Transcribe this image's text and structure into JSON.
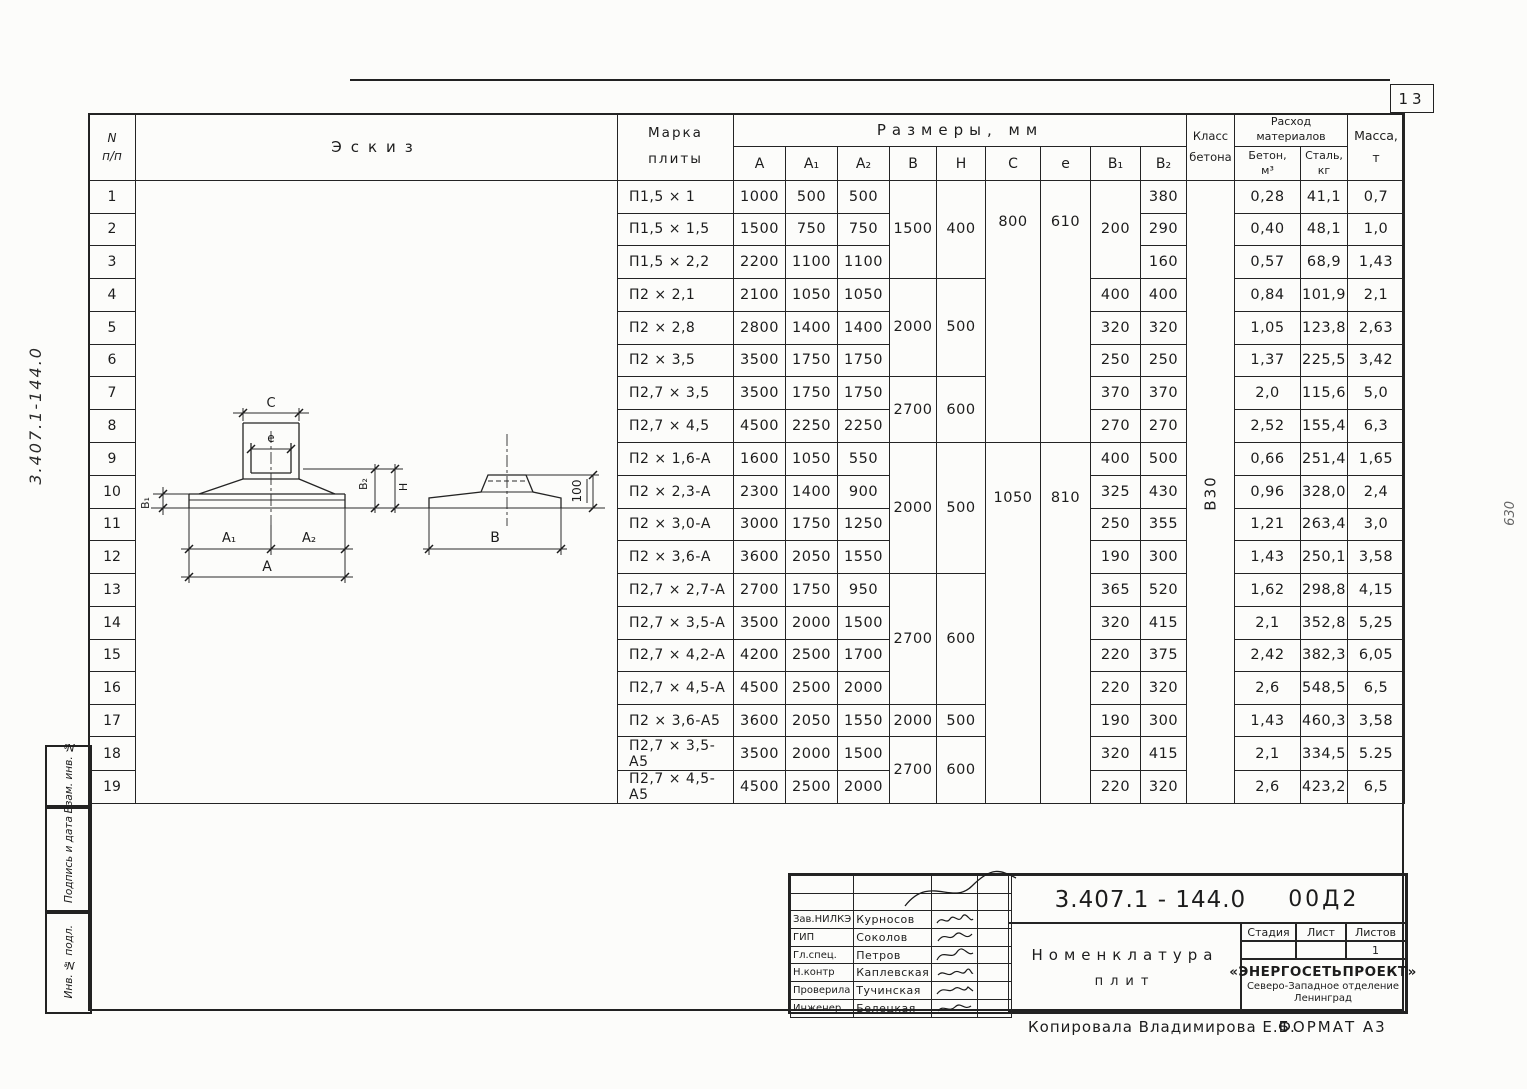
{
  "page": {
    "number": "13",
    "margin_doc_number": "3.407.1-144.0",
    "margin_note_right": "630",
    "copy_note": "Копировала  Владимирова Е.Б.",
    "format_note": "ФОРМАТ А3"
  },
  "left_strip": {
    "sections": [
      "Взам. инв. №",
      "Подпись и дата",
      "Инв. № подл."
    ]
  },
  "table": {
    "headers": {
      "num_top": "N",
      "num_bottom": "п/п",
      "eskiz": "Эскиз",
      "marka_1": "Марка",
      "marka_2": "плиты",
      "razmery": "Размеры,  мм",
      "dims": [
        "А",
        "А₁",
        "А₂",
        "В",
        "Н",
        "С",
        "е",
        "В₁",
        "В₂"
      ],
      "klass_1": "Класс",
      "klass_2": "бетона",
      "rashod_1": "Расход",
      "rashod_2": "материалов",
      "beton_1": "Бетон,",
      "beton_2": "м³",
      "stal_1": "Сталь,",
      "stal_2": "кг",
      "massa_1": "Масса,",
      "massa_2": "т"
    },
    "klass_value": "В30",
    "rows": [
      {
        "n": "1",
        "marka": "П1,5 × 1",
        "A": "1000",
        "A1": "500",
        "A2": "500",
        "B1": "",
        "B2": "380",
        "beton": "0,28",
        "stal": "41,1",
        "massa": "0,7"
      },
      {
        "n": "2",
        "marka": "П1,5 × 1,5",
        "A": "1500",
        "A1": "750",
        "A2": "750",
        "B1": "",
        "B2": "290",
        "beton": "0,40",
        "stal": "48,1",
        "massa": "1,0"
      },
      {
        "n": "3",
        "marka": "П1,5 × 2,2",
        "A": "2200",
        "A1": "1100",
        "A2": "1100",
        "B1": "",
        "B2": "160",
        "beton": "0,57",
        "stal": "68,9",
        "massa": "1,43"
      },
      {
        "n": "4",
        "marka": "П2 × 2,1",
        "A": "2100",
        "A1": "1050",
        "A2": "1050",
        "B1": "400",
        "B2": "400",
        "beton": "0,84",
        "stal": "101,9",
        "massa": "2,1"
      },
      {
        "n": "5",
        "marka": "П2 × 2,8",
        "A": "2800",
        "A1": "1400",
        "A2": "1400",
        "B1": "320",
        "B2": "320",
        "beton": "1,05",
        "stal": "123,8",
        "massa": "2,63"
      },
      {
        "n": "6",
        "marka": "П2 × 3,5",
        "A": "3500",
        "A1": "1750",
        "A2": "1750",
        "B1": "250",
        "B2": "250",
        "beton": "1,37",
        "stal": "225,5",
        "massa": "3,42"
      },
      {
        "n": "7",
        "marka": "П2,7 × 3,5",
        "A": "3500",
        "A1": "1750",
        "A2": "1750",
        "B1": "370",
        "B2": "370",
        "beton": "2,0",
        "stal": "115,6",
        "massa": "5,0"
      },
      {
        "n": "8",
        "marka": "П2,7 × 4,5",
        "A": "4500",
        "A1": "2250",
        "A2": "2250",
        "B1": "270",
        "B2": "270",
        "beton": "2,52",
        "stal": "155,4",
        "massa": "6,3"
      },
      {
        "n": "9",
        "marka": "П2 × 1,6-А",
        "A": "1600",
        "A1": "1050",
        "A2": "550",
        "B1": "400",
        "B2": "500",
        "beton": "0,66",
        "stal": "251,4",
        "massa": "1,65"
      },
      {
        "n": "10",
        "marka": "П2 × 2,3-А",
        "A": "2300",
        "A1": "1400",
        "A2": "900",
        "B1": "325",
        "B2": "430",
        "beton": "0,96",
        "stal": "328,0",
        "massa": "2,4"
      },
      {
        "n": "11",
        "marka": "П2 × 3,0-А",
        "A": "3000",
        "A1": "1750",
        "A2": "1250",
        "B1": "250",
        "B2": "355",
        "beton": "1,21",
        "stal": "263,4",
        "massa": "3,0"
      },
      {
        "n": "12",
        "marka": "П2 × 3,6-А",
        "A": "3600",
        "A1": "2050",
        "A2": "1550",
        "B1": "190",
        "B2": "300",
        "beton": "1,43",
        "stal": "250,1",
        "massa": "3,58"
      },
      {
        "n": "13",
        "marka": "П2,7 × 2,7-А",
        "A": "2700",
        "A1": "1750",
        "A2": "950",
        "B1": "365",
        "B2": "520",
        "beton": "1,62",
        "stal": "298,8",
        "massa": "4,15"
      },
      {
        "n": "14",
        "marka": "П2,7 × 3,5-А",
        "A": "3500",
        "A1": "2000",
        "A2": "1500",
        "B1": "320",
        "B2": "415",
        "beton": "2,1",
        "stal": "352,8",
        "massa": "5,25"
      },
      {
        "n": "15",
        "marka": "П2,7 × 4,2-А",
        "A": "4200",
        "A1": "2500",
        "A2": "1700",
        "B1": "220",
        "B2": "375",
        "beton": "2,42",
        "stal": "382,3",
        "massa": "6,05"
      },
      {
        "n": "16",
        "marka": "П2,7 × 4,5-А",
        "A": "4500",
        "A1": "2500",
        "A2": "2000",
        "B1": "220",
        "B2": "320",
        "beton": "2,6",
        "stal": "548,5",
        "massa": "6,5"
      },
      {
        "n": "17",
        "marka": "П2 × 3,6-А5",
        "A": "3600",
        "A1": "2050",
        "A2": "1550",
        "B1": "190",
        "B2": "300",
        "beton": "1,43",
        "stal": "460,3",
        "massa": "3,58"
      },
      {
        "n": "18",
        "marka": "П2,7 × 3,5-А5",
        "A": "3500",
        "A1": "2000",
        "A2": "1500",
        "B1": "320",
        "B2": "415",
        "beton": "2,1",
        "stal": "334,5",
        "massa": "5.25"
      },
      {
        "n": "19",
        "marka": "П2,7 × 4,5-А5",
        "A": "4500",
        "A1": "2500",
        "A2": "2000",
        "B1": "220",
        "B2": "320",
        "beton": "2,6",
        "stal": "423,2",
        "massa": "6,5"
      }
    ],
    "spans": {
      "B": [
        {
          "row": 1,
          "span": 3,
          "v": "1500"
        },
        {
          "row": 4,
          "span": 3,
          "v": "2000"
        },
        {
          "row": 7,
          "span": 2,
          "v": "2700"
        },
        {
          "row": 9,
          "span": 4,
          "v": "2000"
        },
        {
          "row": 13,
          "span": 4,
          "v": "2700"
        },
        {
          "row": 17,
          "span": 1,
          "v": "2000"
        },
        {
          "row": 18,
          "span": 2,
          "v": "2700"
        }
      ],
      "H": [
        {
          "row": 1,
          "span": 3,
          "v": "400"
        },
        {
          "row": 4,
          "span": 3,
          "v": "500"
        },
        {
          "row": 7,
          "span": 2,
          "v": "600"
        },
        {
          "row": 9,
          "span": 4,
          "v": "500"
        },
        {
          "row": 13,
          "span": 4,
          "v": "600"
        },
        {
          "row": 17,
          "span": 1,
          "v": "500"
        },
        {
          "row": 18,
          "span": 2,
          "v": "600"
        }
      ],
      "C": [
        {
          "row": 1,
          "span": 8,
          "v": "800"
        },
        {
          "row": 9,
          "span": 11,
          "v": "1050"
        }
      ],
      "e": [
        {
          "row": 1,
          "span": 8,
          "v": "610"
        },
        {
          "row": 9,
          "span": 11,
          "v": "810"
        }
      ],
      "B1": [
        {
          "row": 1,
          "span": 3,
          "v": "200"
        }
      ]
    }
  },
  "sketch": {
    "labels": {
      "C": "С",
      "e": "е",
      "B1": "В₁",
      "B2": "В₂",
      "H": "Н",
      "A1": "А₁",
      "A2": "А₂",
      "A": "А",
      "B": "В",
      "d100": "100"
    }
  },
  "titleblock": {
    "doc_number": "3.407.1 - 144.0",
    "doc_suffix": "00Д2",
    "title_line1": "Номенклатура",
    "title_line2": "плит",
    "stadia_label": "Стадия",
    "list_label": "Лист",
    "listov_label": "Листов",
    "listov_value": "1",
    "org1": "«ЭНЕРГОСЕТЬПРОЕКТ»",
    "org2": "Северо-Западное отделение",
    "org3": "Ленинград",
    "sign_rows": [
      {
        "role": "Зав.НИЛКЭ",
        "name": "Курносов"
      },
      {
        "role": "ГИП",
        "name": "Соколов"
      },
      {
        "role": "Гл.спец.",
        "name": "Петров"
      },
      {
        "role": "Н.контр",
        "name": "Каплевская"
      },
      {
        "role": "Проверила",
        "name": "Тучинская"
      },
      {
        "role": "Инженер",
        "name": "Белецкая"
      }
    ]
  }
}
